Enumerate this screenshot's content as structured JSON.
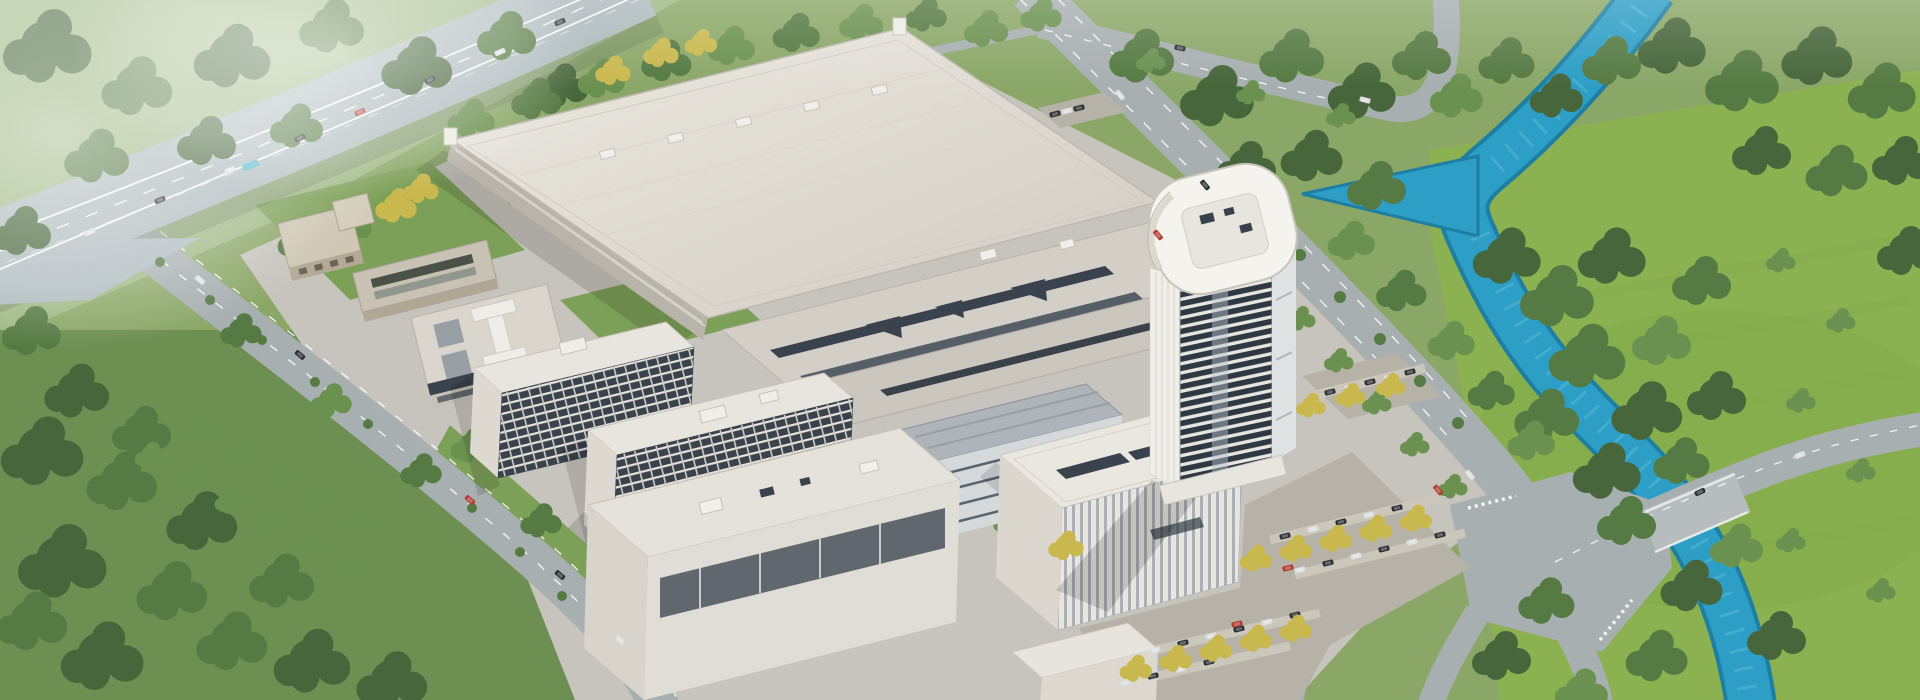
{
  "meta": {
    "description": "aerial-architectural-rendering of an industrial campus",
    "view": "oblique-aerial"
  },
  "palette": {
    "grass_base": "#8BA768",
    "grass_meadow": "#8CB151",
    "grass_field": "#9FB884",
    "grass_garden": "#7DA058",
    "forest_zone": "#6E8F52",
    "forest_dark": "#47663B",
    "forest_mid": "#567A43",
    "forest_light": "#6B9150",
    "tree_yellow": "#C9B84E",
    "river": "#2D9EC6",
    "river_deep": "#1E7FA2",
    "river_light": "#63C2DE",
    "road": "#A8AFB1",
    "highway": "#AEBABD",
    "lane_white": "#FFFFFF",
    "ground": "#C6C4BC",
    "lot": "#B6B2A8",
    "stall": "#CCC7BB",
    "roof_light": "#E9E6DF",
    "roof_mid": "#D3CFC6",
    "facade_shadow": "#B8B4AA",
    "window_dark": "#39424D",
    "glass_dark": "#2E3944",
    "garage_blue": "#AEB4B9",
    "car_dark": "#2A2F33",
    "car_white": "#DDDFDF",
    "car_red": "#B23A2E",
    "truck_teal": "#58B8C8",
    "mist": "#FFFFFF"
  },
  "scene": {
    "landmarks": [
      "elevated-highway",
      "factory-hall",
      "factory-annex",
      "office-tower",
      "headquarters-office",
      "dormitory-block-a",
      "dormitory-block-b",
      "parking-garage",
      "office-building-west",
      "warehouse-pair",
      "south-lowrise",
      "main-parking-lot",
      "north-parking-lot",
      "river",
      "northeast-boulevard",
      "west-avenue",
      "road-intersection",
      "river-bridge",
      "forest",
      "meadow"
    ]
  }
}
